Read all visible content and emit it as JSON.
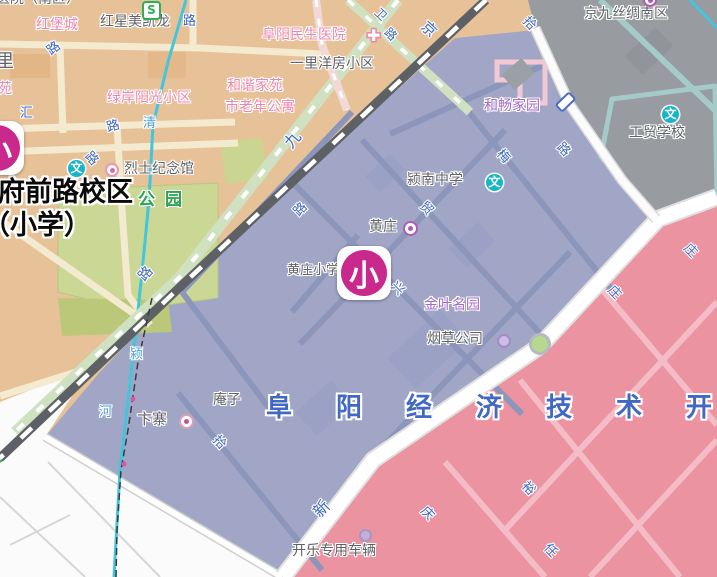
{
  "map": {
    "title": "黄庄小学 学区地图",
    "colors": {
      "zone_tan": "#e7c197",
      "zone_gray": "#989ca0",
      "zone_purple": "#a2a6c6",
      "zone_pink": "#ec93a2",
      "zone_white": "#fbfbfb",
      "park_green": "#cbd795",
      "railway": "#5d6166",
      "river": "#40c6dd",
      "avenue": "#ffffff",
      "marker_magenta": "#c9298c",
      "wen_teal": "#17b5cc",
      "road_label_blue": "#3c67bd",
      "big_zone_text_blue": "#4168c2"
    },
    "text_labels": [
      {
        "name": "label-hospital-south-fragment",
        "text": "医院（南区）",
        "x": -4,
        "y": -9,
        "cls": "c-gray",
        "size": 14
      },
      {
        "name": "label-hongbaocheng",
        "text": "红堡城",
        "x": 36,
        "y": 17,
        "cls": "c-pink",
        "size": 14
      },
      {
        "name": "label-hongxingmeikailong",
        "text": "红星美凯龙",
        "x": 100,
        "y": 14,
        "cls": "c-gray",
        "size": 14
      },
      {
        "name": "label-road-lu-1",
        "text": "路",
        "x": 183,
        "y": 15,
        "cls": "c-road",
        "size": 13
      },
      {
        "name": "label-fuyang-minsheng-hospital",
        "text": "阜阳民生医院",
        "x": 262,
        "y": 27,
        "cls": "c-pink",
        "size": 14
      },
      {
        "name": "label-yiliyangfang",
        "text": "一里洋房小区",
        "x": 290,
        "y": 56,
        "cls": "c-gray",
        "size": 14
      },
      {
        "name": "label-li-fragment",
        "text": "里",
        "x": -4,
        "y": 52,
        "cls": "c-gray",
        "size": 18
      },
      {
        "name": "label-hexiejiayuan",
        "text": "和谐家苑",
        "x": 227,
        "y": 78,
        "cls": "c-pink",
        "size": 14
      },
      {
        "name": "label-shilaonian",
        "text": "市老年公寓",
        "x": 225,
        "y": 99,
        "cls": "c-pink",
        "size": 14
      },
      {
        "name": "label-lvanyangguang",
        "text": "绿岸阳光小区",
        "x": 107,
        "y": 90,
        "cls": "c-pink",
        "size": 14
      },
      {
        "name": "label-yuan-fragment",
        "text": "苑",
        "x": -2,
        "y": 81,
        "cls": "c-pink",
        "size": 14
      },
      {
        "name": "label-road-lu-2",
        "text": "路",
        "x": 48,
        "y": 42,
        "cls": "c-road",
        "size": 13,
        "rot": -38
      },
      {
        "name": "label-road-hui",
        "text": "汇",
        "x": 20,
        "y": 107,
        "cls": "c-road",
        "size": 13
      },
      {
        "name": "label-road-lu-3",
        "text": "路",
        "x": 107,
        "y": 120,
        "cls": "c-road",
        "size": 13,
        "rot": -15
      },
      {
        "name": "label-river-qing",
        "text": "清",
        "x": 143,
        "y": 117,
        "cls": "c-river",
        "size": 13
      },
      {
        "name": "label-road-lu-4",
        "text": "路",
        "x": 84,
        "y": 152,
        "cls": "c-road",
        "size": 13,
        "rot": 48
      },
      {
        "name": "label-lieshijinianguan",
        "text": "烈士纪念馆",
        "x": 124,
        "y": 161,
        "cls": "c-gray",
        "size": 14
      },
      {
        "name": "label-park",
        "text": "公园",
        "x": 138,
        "y": 191,
        "cls": "c-green",
        "size": 17,
        "ls": 10
      },
      {
        "name": "label-fuqianlu-campus",
        "text": "府前路校区",
        "x": -2,
        "y": 177,
        "cls": "c-bold",
        "size": 27
      },
      {
        "name": "label-fuqianlu-primary",
        "text": "（小学）",
        "x": -17,
        "y": 210,
        "cls": "c-bold",
        "size": 27
      },
      {
        "name": "label-jingjiusichou",
        "text": "京九丝绸南区",
        "x": 584,
        "y": 6,
        "cls": "c-gray",
        "size": 14
      },
      {
        "name": "label-hechangjiayuan",
        "text": "和畅家园",
        "x": 484,
        "y": 98,
        "cls": "c-purple",
        "size": 14
      },
      {
        "name": "label-gongmao-school",
        "text": "工贸学校",
        "x": 629,
        "y": 125,
        "cls": "c-gray",
        "size": 14
      },
      {
        "name": "label-yingnan-middle-school",
        "text": "颍南中学",
        "x": 407,
        "y": 172,
        "cls": "c-gray",
        "size": 14
      },
      {
        "name": "label-huangzhuang",
        "text": "黄庄",
        "x": 369,
        "y": 219,
        "cls": "c-gray",
        "size": 14
      },
      {
        "name": "label-huangzhuang-primary-poi",
        "text": "黄庄小学",
        "x": 287,
        "y": 264,
        "cls": "c-gray",
        "size": 13
      },
      {
        "name": "label-jinyemingyuan",
        "text": "金叶名园",
        "x": 424,
        "y": 297,
        "cls": "c-purple",
        "size": 14
      },
      {
        "name": "label-yancaogongsi",
        "text": "烟草公司",
        "x": 427,
        "y": 331,
        "cls": "c-gray",
        "size": 14
      },
      {
        "name": "label-anzi",
        "text": "庵子",
        "x": 213,
        "y": 392,
        "cls": "c-gray",
        "size": 14
      },
      {
        "name": "label-bianzhai",
        "text": "卞寨",
        "x": 137,
        "y": 411,
        "cls": "c-gray",
        "size": 15
      },
      {
        "name": "label-kaile-vehicle",
        "text": "开乐专用车辆",
        "x": 292,
        "y": 543,
        "cls": "c-gray",
        "size": 14
      },
      {
        "name": "label-economic-zone",
        "text": "阜阳经济技术开",
        "x": 266,
        "y": 394,
        "cls": "c-big",
        "size": 26,
        "ls": 44
      },
      {
        "name": "label-railway-jing",
        "text": "京",
        "x": 421,
        "y": 21,
        "cls": "c-road",
        "size": 15,
        "rot": 43
      },
      {
        "name": "label-railway-jiu",
        "text": "九",
        "x": 285,
        "y": 131,
        "cls": "c-road",
        "size": 16,
        "rot": -50
      },
      {
        "name": "label-jingjiu-lu",
        "text": "路",
        "x": 139,
        "y": 266,
        "cls": "c-road",
        "size": 14,
        "rot": -48
      },
      {
        "name": "label-road-wei",
        "text": "卫",
        "x": 374,
        "y": 8,
        "cls": "c-road",
        "size": 12,
        "rot": 44
      },
      {
        "name": "label-road-lu-5",
        "text": "路",
        "x": 384,
        "y": 28,
        "cls": "c-road",
        "size": 12,
        "rot": 44
      },
      {
        "name": "label-road-shi-1",
        "text": "拾",
        "x": 522,
        "y": 17,
        "cls": "c-road",
        "size": 13,
        "rot": 46
      },
      {
        "name": "label-road-lu-6",
        "text": "路",
        "x": 556,
        "y": 143,
        "cls": "c-road",
        "size": 13,
        "rot": 46
      },
      {
        "name": "label-road-lu-7",
        "text": "路",
        "x": 295,
        "y": 203,
        "cls": "c-road",
        "size": 13,
        "rot": -46
      },
      {
        "name": "label-road-mao",
        "text": "贸",
        "x": 419,
        "y": 202,
        "cls": "c-road",
        "size": 13,
        "rot": 46
      },
      {
        "name": "label-road-xing",
        "text": "兴",
        "x": 390,
        "y": 282,
        "cls": "c-road",
        "size": 13,
        "rot": 46
      },
      {
        "name": "label-road-mei",
        "text": "梅",
        "x": 496,
        "y": 150,
        "cls": "c-road",
        "size": 13,
        "rot": 46
      },
      {
        "name": "label-road-shi-2",
        "text": "拾",
        "x": 212,
        "y": 436,
        "cls": "c-road",
        "size": 13,
        "rot": 46
      },
      {
        "name": "label-road-xin",
        "text": "新",
        "x": 314,
        "y": 500,
        "cls": "c-road",
        "size": 16,
        "rot": -46
      },
      {
        "name": "label-road-qing2",
        "text": "庆",
        "x": 420,
        "y": 507,
        "cls": "c-road",
        "size": 13,
        "rot": 46
      },
      {
        "name": "label-road-yu",
        "text": "裕",
        "x": 521,
        "y": 482,
        "cls": "c-road",
        "size": 13,
        "rot": 46
      },
      {
        "name": "label-road-ren",
        "text": "任",
        "x": 543,
        "y": 544,
        "cls": "c-road",
        "size": 13,
        "rot": 46
      },
      {
        "name": "label-road-zhuang-1",
        "text": "庄",
        "x": 607,
        "y": 286,
        "cls": "c-road",
        "size": 13,
        "rot": 46
      },
      {
        "name": "label-road-zhuang-2",
        "text": "庄",
        "x": 683,
        "y": 244,
        "cls": "c-road",
        "size": 13,
        "rot": 46
      },
      {
        "name": "label-river-ying",
        "text": "颍",
        "x": 130,
        "y": 348,
        "cls": "c-river",
        "size": 13
      },
      {
        "name": "label-river-he",
        "text": "河",
        "x": 99,
        "y": 406,
        "cls": "c-river",
        "size": 13
      }
    ],
    "icons": [
      {
        "name": "subway-s-icon",
        "type": "s",
        "text": "S",
        "x": 142,
        "y": 1
      },
      {
        "name": "hospital-cross-icon",
        "type": "cross",
        "text": "✚",
        "x": 367,
        "y": 26
      },
      {
        "name": "school-wen-icon-fuqianlu",
        "type": "wen",
        "text": "文",
        "x": 68,
        "y": 160
      },
      {
        "name": "martyr-memorial-dot",
        "type": "ringdot",
        "x": 105,
        "y": 163,
        "size": 14,
        "ring": "#e89ab5",
        "fill": "#fff",
        "core": "#e06d9d"
      },
      {
        "name": "school-wen-icon-yingnan",
        "type": "wen",
        "text": "文",
        "x": 486,
        "y": 174
      },
      {
        "name": "huangzhuang-dot",
        "type": "ringdot",
        "x": 403,
        "y": 221,
        "size": 15,
        "ring": "#b05bb0",
        "fill": "#fff",
        "core": "#b05bb0"
      },
      {
        "name": "school-wen-icon-gongmao",
        "type": "wen",
        "text": "文",
        "x": 662,
        "y": 106
      },
      {
        "name": "jingjiusichou-dot",
        "type": "ringdot",
        "x": 643,
        "y": -7,
        "size": 14,
        "ring": "#b05bb0",
        "fill": "#fff",
        "core": "#b05bb0"
      },
      {
        "name": "yancao-dot",
        "type": "ringdot",
        "x": 497,
        "y": 334,
        "size": 14,
        "ring": "#9e8cc4",
        "fill": "#cbbde4"
      },
      {
        "name": "roundabout-circle",
        "type": "roundabout",
        "x": 529,
        "y": 333
      },
      {
        "name": "bianzhai-dot",
        "type": "ringdot",
        "x": 179,
        "y": 414,
        "size": 15,
        "ring": "#d9a0b8",
        "fill": "#fff",
        "core": "#cf4d97"
      },
      {
        "name": "kaile-dot",
        "type": "ringdot",
        "x": 359,
        "y": 529,
        "size": 13,
        "ring": "#a994c6",
        "fill": "#c4b0d6"
      },
      {
        "name": "road-number-badge",
        "type": "badge",
        "x": 560,
        "y": 92,
        "rot": 46
      }
    ],
    "markers": [
      {
        "name": "huangzhuang-primary-marker",
        "char": "小",
        "x": 337,
        "y": 246
      },
      {
        "name": "fuqianlu-campus-marker",
        "char": "小",
        "x": -30,
        "y": 121
      }
    ]
  }
}
